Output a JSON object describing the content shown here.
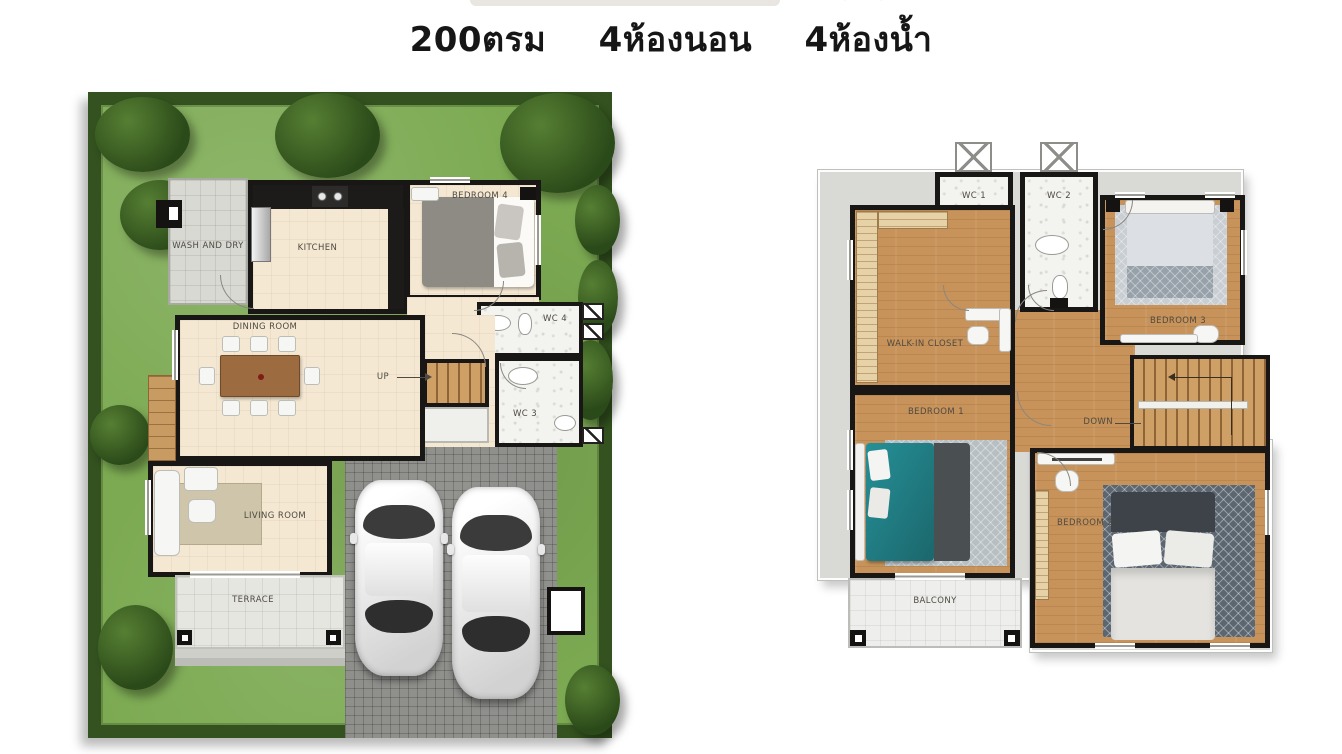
{
  "header": {
    "area": "200ตรม",
    "bedrooms": "4ห้องนอน",
    "bathrooms": "4ห้องน้ำ"
  },
  "floor1": {
    "labels": {
      "wash_and_dry": "WASH AND DRY",
      "kitchen": "KITCHEN",
      "bedroom4": "BEDROOM 4",
      "wc4": "WC 4",
      "wc3": "WC 3",
      "dining_room": "DINING ROOM",
      "up": "UP",
      "living_room": "LIVING ROOM",
      "terrace": "TERRACE"
    }
  },
  "floor2": {
    "labels": {
      "wc1": "WC 1",
      "wc2": "WC 2",
      "walk_in_closet": "WALK-IN CLOSET",
      "bedroom3": "BEDROOM 3",
      "bedroom1": "BEDROOM 1",
      "down": "DOWN",
      "bedroom2": "BEDROOM 2",
      "balcony": "BALCONY"
    }
  },
  "colors": {
    "grass": "#7caa52",
    "hedge": "#33521f",
    "cream_floor": "#f5e8d3",
    "wood_floor": "#c7935a",
    "slab_gray": "#d9d9d6",
    "wall_black": "#181715",
    "paver_gray": "#8f8f8c",
    "teal_bed": "#1f7a80",
    "terrace_tile": "#e6e6e1"
  }
}
